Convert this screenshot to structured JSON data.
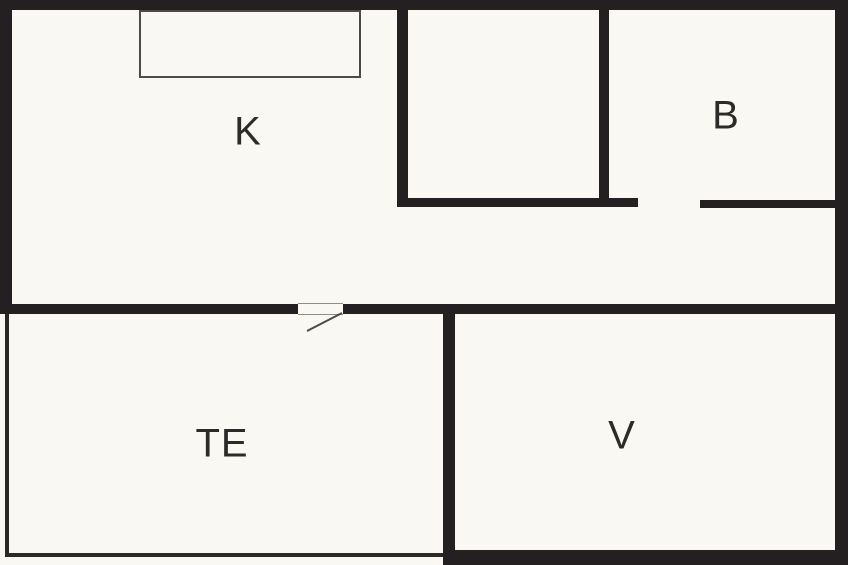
{
  "plan": {
    "type": "floor-plan",
    "rooms": [
      {
        "label": "K"
      },
      {
        "label": "B"
      },
      {
        "label": "TE"
      },
      {
        "label": "V"
      }
    ],
    "colors": {
      "wall": "#242021",
      "background": "#f9f8f2",
      "thin_line": "#4e4a48"
    }
  }
}
